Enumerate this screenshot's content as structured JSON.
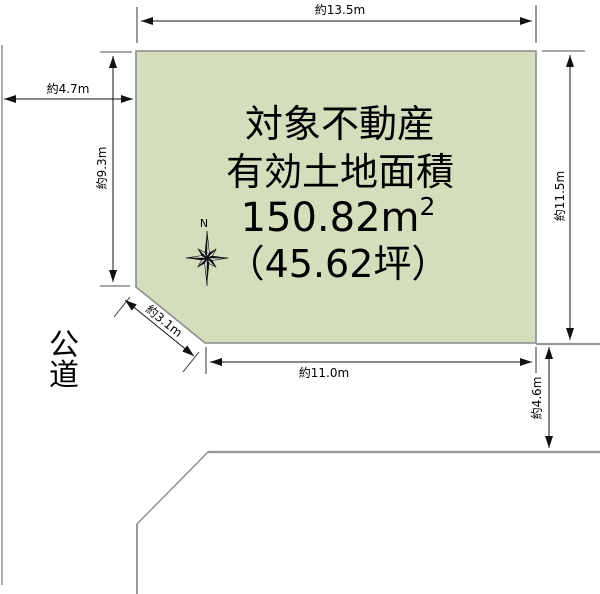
{
  "diagram": {
    "colors": {
      "parcel_fill": "#d5debc",
      "parcel_border": "#8c8c8c",
      "road_line": "#999999",
      "dimension_line": "#111111"
    },
    "parcel": {
      "label_line1": "対象不動産",
      "label_line2": "有効土地面積",
      "area_value": "150.82m",
      "area_superscript": "2",
      "area_tsubo": "（45.62坪）"
    },
    "dimensions": {
      "north_edge": "約13.5m",
      "west_road_width": "約4.7m",
      "west_edge": "約9.3m",
      "east_edge": "約11.5m",
      "south_edge": "約11.0m",
      "corner_cut": "約3.1m",
      "south_road_width": "約4.6m"
    },
    "labels": {
      "public_road": "公道",
      "north": "N"
    }
  }
}
